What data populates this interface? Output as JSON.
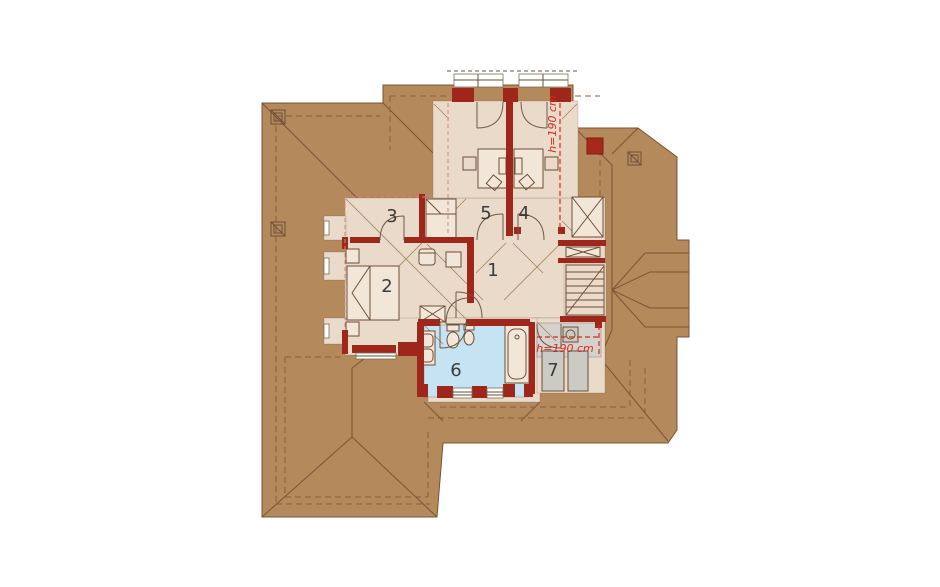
{
  "plan": {
    "type": "attic-floor-plan",
    "rooms": {
      "hall": "1",
      "bedroom": "2",
      "room3": "3",
      "room4": "4",
      "room5": "5",
      "bathroom": "6",
      "storage": "7"
    },
    "annotations": {
      "height_top": "h=190 cm",
      "height_bottom": "h=190 cm"
    },
    "colors": {
      "roof": "#b4895b",
      "roof-line": "#7a5434",
      "eave": "#8a5f3c",
      "floor": "#eadaca",
      "bath": "#c5e3f3",
      "grayfloor": "#d5d2cd",
      "wall": "#9e261b",
      "ann": "#d42b1e",
      "knee": "#d0897b",
      "furn": "#6e4f38",
      "label": "#3b3b3b"
    }
  }
}
